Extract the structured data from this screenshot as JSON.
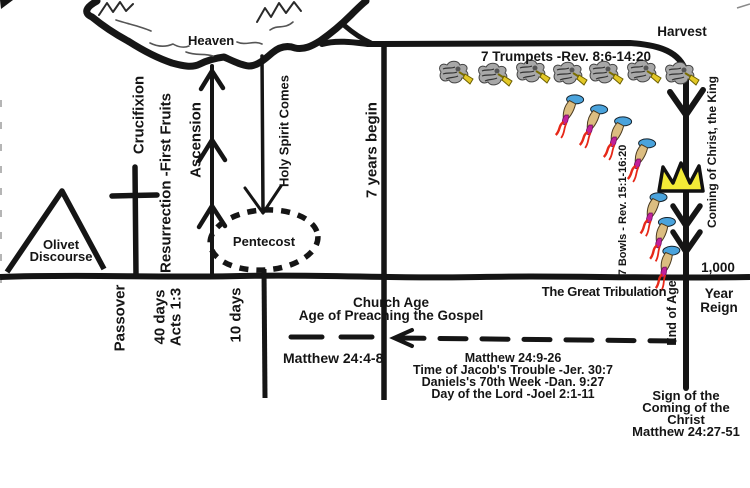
{
  "title": "Olivet Discourse prophecy timeline chart",
  "labels": {
    "heaven": "Heaven",
    "harvest": "Harvest",
    "olivet_line1": "Olivet",
    "olivet_line2": "Discourse",
    "crucifixion": "Crucifixion",
    "resurrection": "Resurrection -First Fruits",
    "ascension": "Ascension",
    "holy_spirit": "Holy Spirit Comes",
    "pentecost": "Pentecost",
    "passover": "Passover",
    "forty_days": "40 days",
    "acts": "Acts 1:3",
    "ten_days": "10 days",
    "seven_years": "7 years begin",
    "trumpets": "7 Trumpets -Rev. 8:6-14:20",
    "bowls": "7 Bowls - Rev. 15:1-16:20",
    "coming_of_christ": "Coming of Christ, the King",
    "church_age_line1": "Church Age",
    "church_age_line2": "Age of Preaching the Gospel",
    "matthew_24_4_8": "Matthew 24:4-8",
    "great_tribulation": "The Great Tribulation",
    "end_of_age": "End of Age",
    "thousand": "1,000",
    "year": "Year",
    "reign": "Reign",
    "tribulation_refs": [
      "Matthew 24:9-26",
      "Time of Jacob's Trouble -Jer. 30:7",
      "Daniels's 70th Week -Dan. 9:27",
      "Day of the Lord -Joel 2:1-11"
    ],
    "sign_lines": [
      "Sign of the",
      "Coming of the",
      "Christ",
      "Matthew 24:27-51"
    ]
  },
  "icons": {
    "trumpet_angel": {
      "name": "trumpet-angel-icon",
      "count": 7
    },
    "pouring_bowl": {
      "name": "bowl-pouring-icon",
      "count": 7
    },
    "crown": {
      "name": "crown-icon",
      "count": 1
    }
  },
  "colors": {
    "ink": "#151515",
    "trumpet_yellow": "#e3c827",
    "crown_yellow": "#f3eb37",
    "bowl_blue": "#4aa3dc",
    "bowl_tan": "#dcbd80",
    "bowl_red": "#e62818",
    "bowl_magenta": "#c2209a"
  }
}
